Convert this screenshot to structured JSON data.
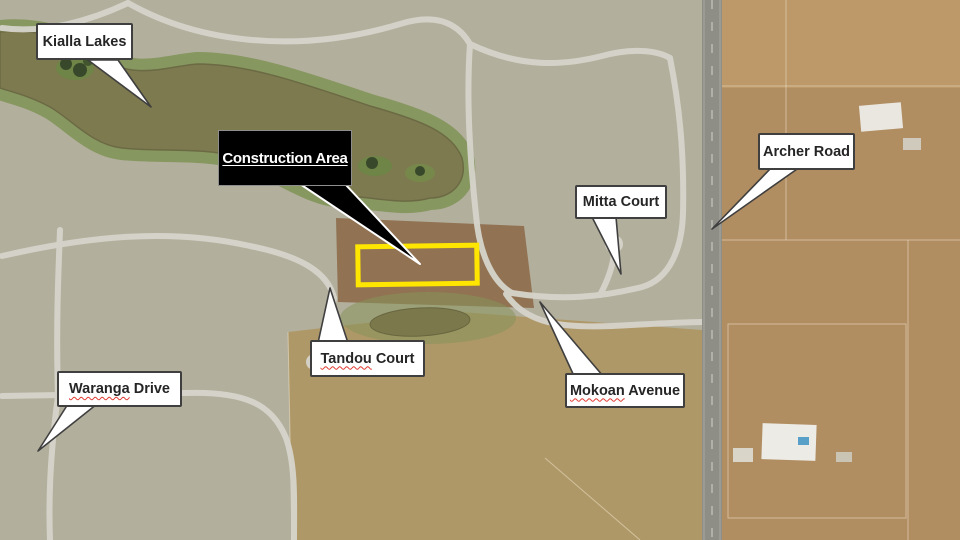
{
  "construction": {
    "label": "Construction Area"
  },
  "callouts": [
    {
      "id": "kialla-lakes",
      "misspelled": "",
      "rest": "Kialla Lakes"
    },
    {
      "id": "mitta-court",
      "misspelled": "",
      "rest": "Mitta Court"
    },
    {
      "id": "archer-road",
      "misspelled": "",
      "rest": "Archer Road"
    },
    {
      "id": "tandou-court",
      "misspelled": "Tandou",
      "rest": " Court"
    },
    {
      "id": "mokoan-avenue",
      "misspelled": "Mokoan",
      "rest": " Avenue"
    },
    {
      "id": "waranga-drive",
      "misspelled": "Waranga",
      "rest": " Drive"
    }
  ],
  "colors": {
    "highlight_rectangle": "#ffe600",
    "callout_bg": "#ffffff",
    "callout_border": "#3f3f3f",
    "callout_text": "#252525",
    "construction_bg": "#000000",
    "construction_text": "#ffffff",
    "spellcheck_underline": "#e0392e",
    "lake_water": "#7d7a4f",
    "parkland": "#7a9150",
    "rural_land": "#b18d62",
    "road": "#8e8e87"
  }
}
